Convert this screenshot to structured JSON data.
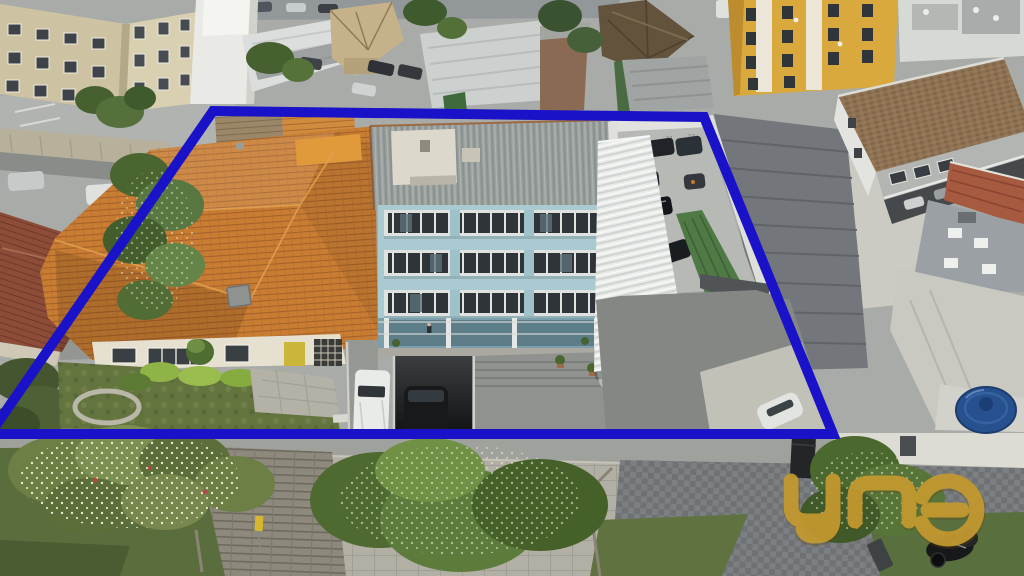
{
  "meta": {
    "type": "aerial-drone-photograph",
    "subject": "Urban block seen from above with a property lot outlined in blue; terracotta-roof house and light-blue four-storey building inside the outline; watermark logo bottom right"
  },
  "annotation": {
    "label": "property-boundary",
    "color": "#1a12c8",
    "stroke_width": 10,
    "points_str": "213,111 704,117 833,434 -10,434"
  },
  "watermark": {
    "text": "una",
    "color": "#c59a30",
    "shadow_color": "#5f4a12",
    "opacity": 0.92
  },
  "scene": {
    "parking_spot_numbers": [
      "10",
      "11",
      "12"
    ],
    "palette": {
      "roof_orange": "#c87d33",
      "roof_red_dark": "#8d4c38",
      "teal_building": "#a9cad1",
      "teal_roof_gray": "#9ba19f",
      "white_awning": "#e9ebe9",
      "yellow_building": "#d9a93e",
      "beige_building": "#cdc3a2",
      "pavement": "#a8aba7",
      "sidewalk_light": "#b2afa5",
      "pavers_dark": "#6e7274",
      "grass": "#5a6d3c",
      "water_tank_blue": "#27508f",
      "hedge_lime": "#8fb347"
    }
  }
}
